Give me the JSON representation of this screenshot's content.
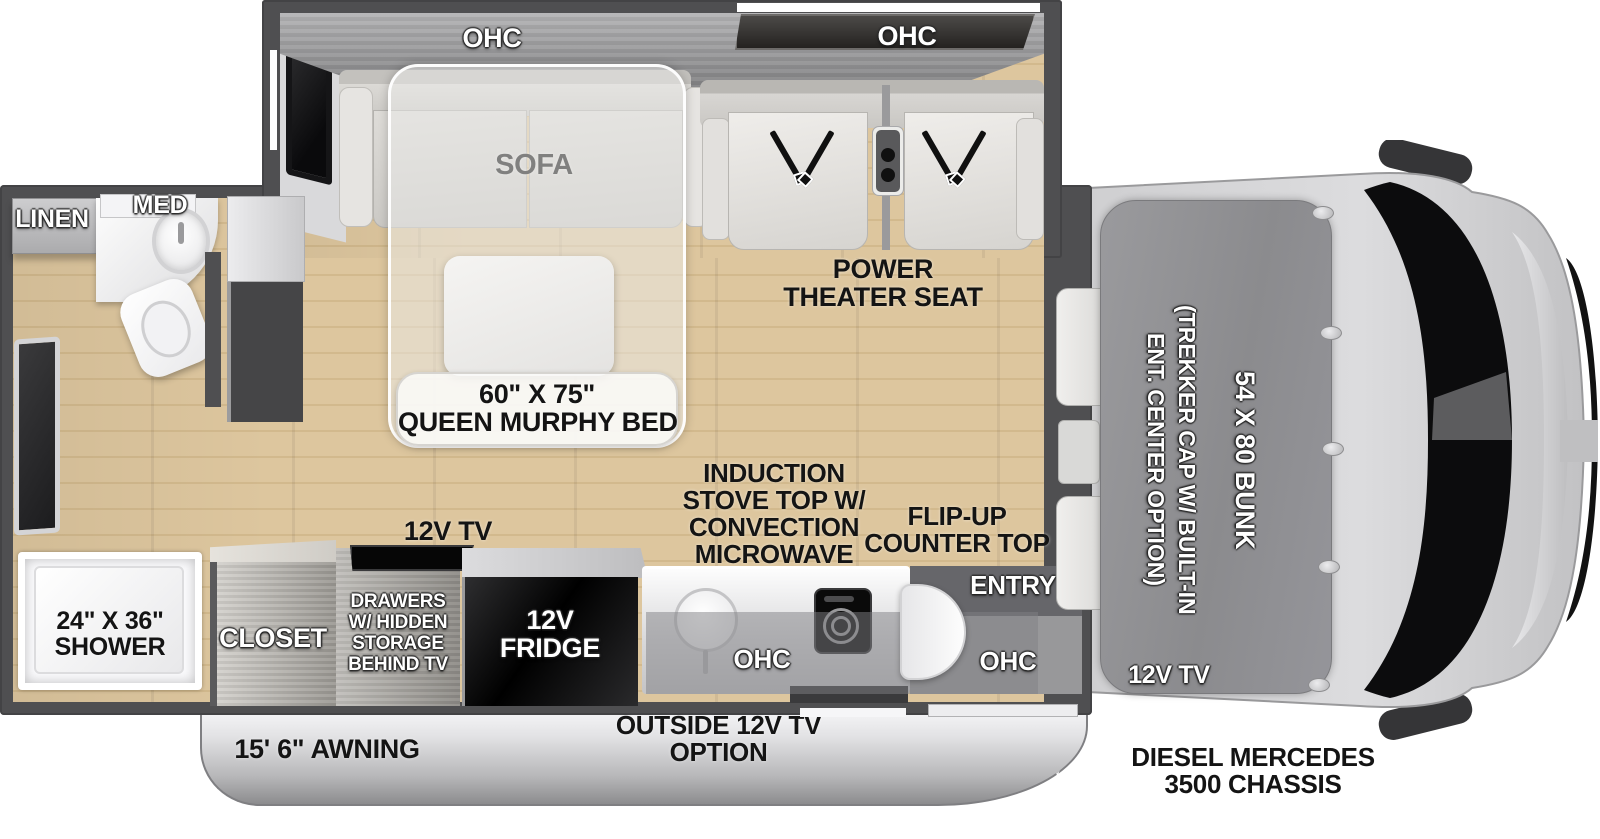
{
  "slideout": {
    "ohc_left": "OHC",
    "ohc_right": "OHC",
    "sofa": "SOFA",
    "theater": {
      "line1": "POWER",
      "line2": "THEATER SEAT"
    }
  },
  "murphy_bed": {
    "line1": "60\" X 75\"",
    "line2": "QUEEN MURPHY BED"
  },
  "bathroom": {
    "linen": "LINEN",
    "med": "MED",
    "shower": {
      "line1": "24\" X 36\"",
      "line2": "SHOWER"
    }
  },
  "kitchen": {
    "tv_label": "12V TV",
    "closet": "CLOSET",
    "drawers_lines": [
      "DRAWERS",
      "W/ HIDDEN",
      "STORAGE",
      "BEHIND TV"
    ],
    "fridge": {
      "line1": "12V",
      "line2": "FRIDGE"
    },
    "induction_lines": [
      "INDUCTION",
      "STOVE TOP W/",
      "CONVECTION",
      "MICROWAVE"
    ],
    "flip_up": {
      "line1": "FLIP-UP",
      "line2": "COUNTER TOP"
    },
    "entry": "ENTRY",
    "ohc_counter": "OHC",
    "ohc_entry": "OHC"
  },
  "cab": {
    "trekker_line1": "(TREKKER CAP W/ BUILT-IN",
    "trekker_line2": "ENT. CENTER OPTION)",
    "bunk": "54 X 80 BUNK",
    "tv_label": "12V TV"
  },
  "exterior": {
    "awning": "15' 6\" AWNING",
    "outside_tv": {
      "line1": "OUTSIDE 12V TV",
      "line2": "OPTION"
    },
    "chassis": {
      "line1": "DIESEL MERCEDES",
      "line2": "3500 CHASSIS"
    }
  },
  "colors": {
    "wall": "#4f4f51",
    "floor": "#dcc49c",
    "cabinet_dark": "#2b2927",
    "label_black": "#141414",
    "label_white": "#ffffff"
  }
}
